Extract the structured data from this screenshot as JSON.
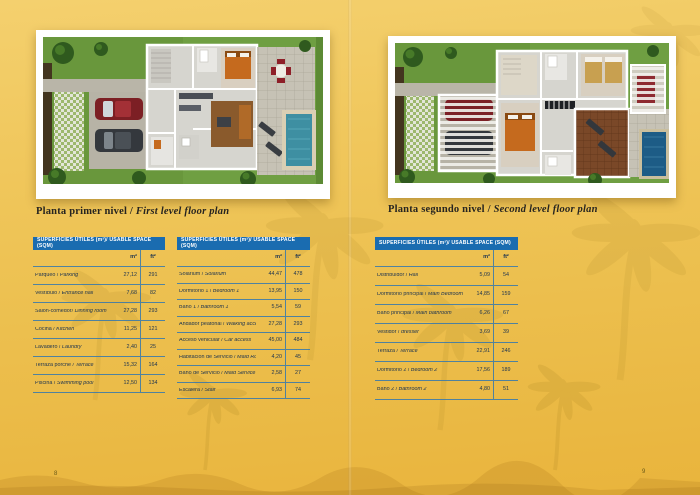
{
  "colors": {
    "accent_blue": "#1a6cb0",
    "rule_blue": "#2873b4",
    "background_gold": "#ecc052",
    "text_dark": "#1c3350"
  },
  "tables_common": {
    "header": "SUPERFICIES ÚTILES (m²)/ USABLE SPACE (SQM)",
    "col_m2": "m²",
    "col_ft2": "ft²"
  },
  "left_page": {
    "page_number": "8",
    "title_es": "Planta primer nivel",
    "title_sep": " / ",
    "title_en": "First level floor plan",
    "tables": [
      {
        "rows": [
          {
            "es": "Parqueo",
            "en": "Parking",
            "m2": "27,12",
            "ft2": "291"
          },
          {
            "es": "Vestíbulo",
            "en": "Entrance hall",
            "m2": "7,68",
            "ft2": "82"
          },
          {
            "es": "Salón-comedor",
            "sep": "/ ",
            "en": "Dinning room",
            "m2": "27,28",
            "ft2": "293"
          },
          {
            "es": "Cocina",
            "en": "Kitchen",
            "m2": "11,25",
            "ft2": "121"
          },
          {
            "es": "Lavadero",
            "en": "Laundry",
            "m2": "2,40",
            "ft2": "25"
          },
          {
            "es": "Terraza porche",
            "en": "Terrace",
            "m2": "15,32",
            "ft2": "164"
          },
          {
            "es": "Piscina",
            "en": "Swimming pool",
            "m2": "12,50",
            "ft2": "134"
          }
        ]
      },
      {
        "rows": [
          {
            "es": "Solarium",
            "en": "Solarium",
            "m2": "44,47",
            "ft2": "478"
          },
          {
            "es": "Dormitorio 1",
            "en": "Bedroom 1",
            "m2": "13,95",
            "ft2": "150"
          },
          {
            "es": "Baño 1",
            "en": "Bathroom 1",
            "m2": "5,54",
            "ft2": "59"
          },
          {
            "es": "Andador peatonal",
            "en": "Walking access",
            "m2": "27,28",
            "ft2": "293"
          },
          {
            "es": "Acceso vehicular",
            "en": "Car access",
            "m2": "45,00",
            "ft2": "484"
          },
          {
            "es": "Habitación de Servicio",
            "en": "Maid Room",
            "m2": "4,20",
            "ft2": "45"
          },
          {
            "es": "Baño de Servicio",
            "en": "Maid Service",
            "m2": "2,58",
            "ft2": "27"
          },
          {
            "es": "Escalera",
            "en": "Stair",
            "m2": "6,93",
            "ft2": "74"
          }
        ]
      }
    ]
  },
  "right_page": {
    "page_number": "9",
    "title_es": "Planta segundo nivel",
    "title_sep": " / ",
    "title_en": "Second level floor plan",
    "tables": [
      {
        "rows": [
          {
            "es": "Distribuidor",
            "en": "Hall",
            "m2": "5,09",
            "ft2": "54"
          },
          {
            "es": "Dormitorio principal",
            "en": "Main Bedroom",
            "m2": "14,85",
            "ft2": "159"
          },
          {
            "es": "Baño principal",
            "en": "Main bathroom",
            "m2": "6,26",
            "ft2": "67"
          },
          {
            "es": "Vestidor",
            "en": "dresser",
            "m2": "3,69",
            "ft2": "39"
          },
          {
            "es": "Terraza",
            "en": "Terrace",
            "m2": "22,91",
            "ft2": "246"
          },
          {
            "es": "Dormitorio 2",
            "en": "Bedroom 2",
            "m2": "17,56",
            "ft2": "189"
          },
          {
            "es": "Baño 2",
            "en": "Bathroom 2",
            "m2": "4,80",
            "ft2": "51"
          }
        ]
      }
    ]
  }
}
